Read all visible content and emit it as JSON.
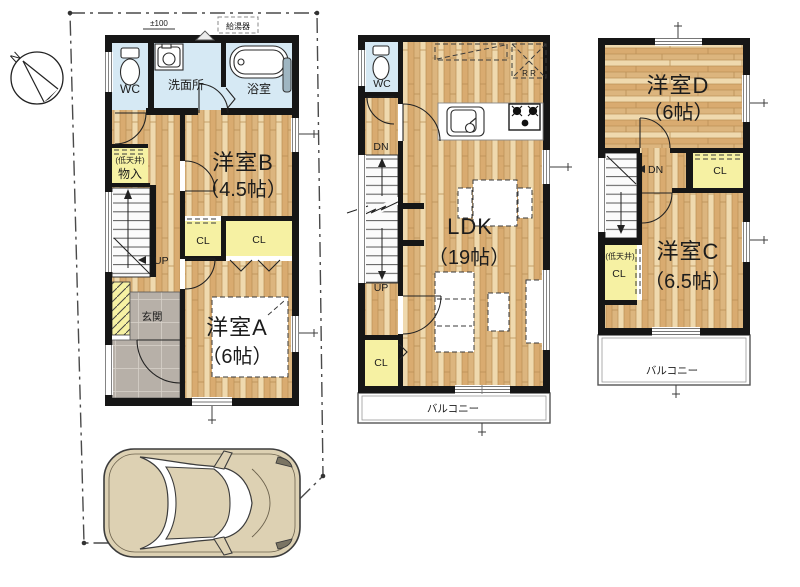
{
  "site": {
    "north_label": "N",
    "elevation_label": "±100",
    "water_heater_label": "給湯器"
  },
  "floor1": {
    "wc_label": "WC",
    "washroom_label": "洗面所",
    "bath_label": "浴室",
    "room_b_name": "洋室B",
    "room_b_size": "（4.5帖）",
    "storage_ceiling_note": "(低天井)",
    "storage_label": "物入",
    "up_label": "UP",
    "closet1_label": "CL",
    "closet2_label": "CL",
    "entrance_label": "玄関",
    "room_a_name": "洋室A",
    "room_a_size": "（6帖）"
  },
  "floor2": {
    "wc_label": "WC",
    "dn_label": "DN",
    "up_label": "UP",
    "closet_label": "CL",
    "ldk_name": "LDK",
    "ldk_size": "（19帖）",
    "fridge_label": "R R",
    "balcony_label": "バルコニー"
  },
  "floor3": {
    "room_d_name": "洋室D",
    "room_d_size": "（6帖）",
    "dn_label": "DN",
    "closet1_label": "CL",
    "storage_ceiling_note": "(低天井)",
    "closet2_label": "CL",
    "room_c_name": "洋室C",
    "room_c_size": "（6.5帖）",
    "balcony_label": "バルコニー"
  },
  "colors": {
    "wall": "#161616",
    "water_room": "#d6e9f4",
    "wood": "#e2c08d",
    "closet_yellow": "#f6f1a3",
    "tile_gray": "#b7b0a8",
    "car_body": "#ddd1b3"
  }
}
